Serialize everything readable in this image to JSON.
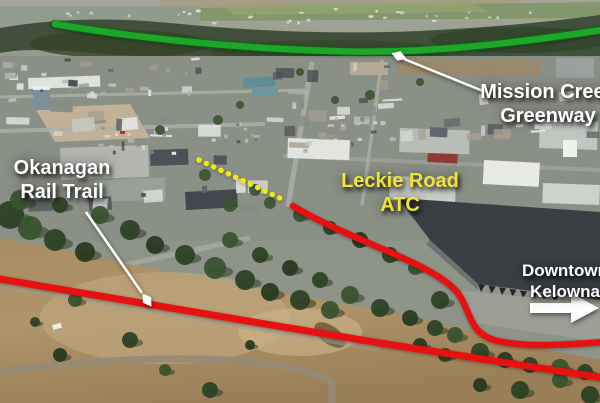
{
  "annotations": {
    "greenway": {
      "label": [
        "Mission Creek",
        "Greenway"
      ],
      "route_color": "#1ca62a"
    },
    "rail_trail": {
      "label": [
        "Okanagan",
        "Rail Trail"
      ],
      "route_color": "#e81111"
    },
    "atc": {
      "label": [
        "Leckie Road",
        "ATC"
      ],
      "route_color": "#f6e90e",
      "label_color": "#f2e434"
    },
    "downtown": {
      "label": [
        "Downtown",
        "Kelowna"
      ],
      "arrow_color": "#ffffff"
    }
  }
}
